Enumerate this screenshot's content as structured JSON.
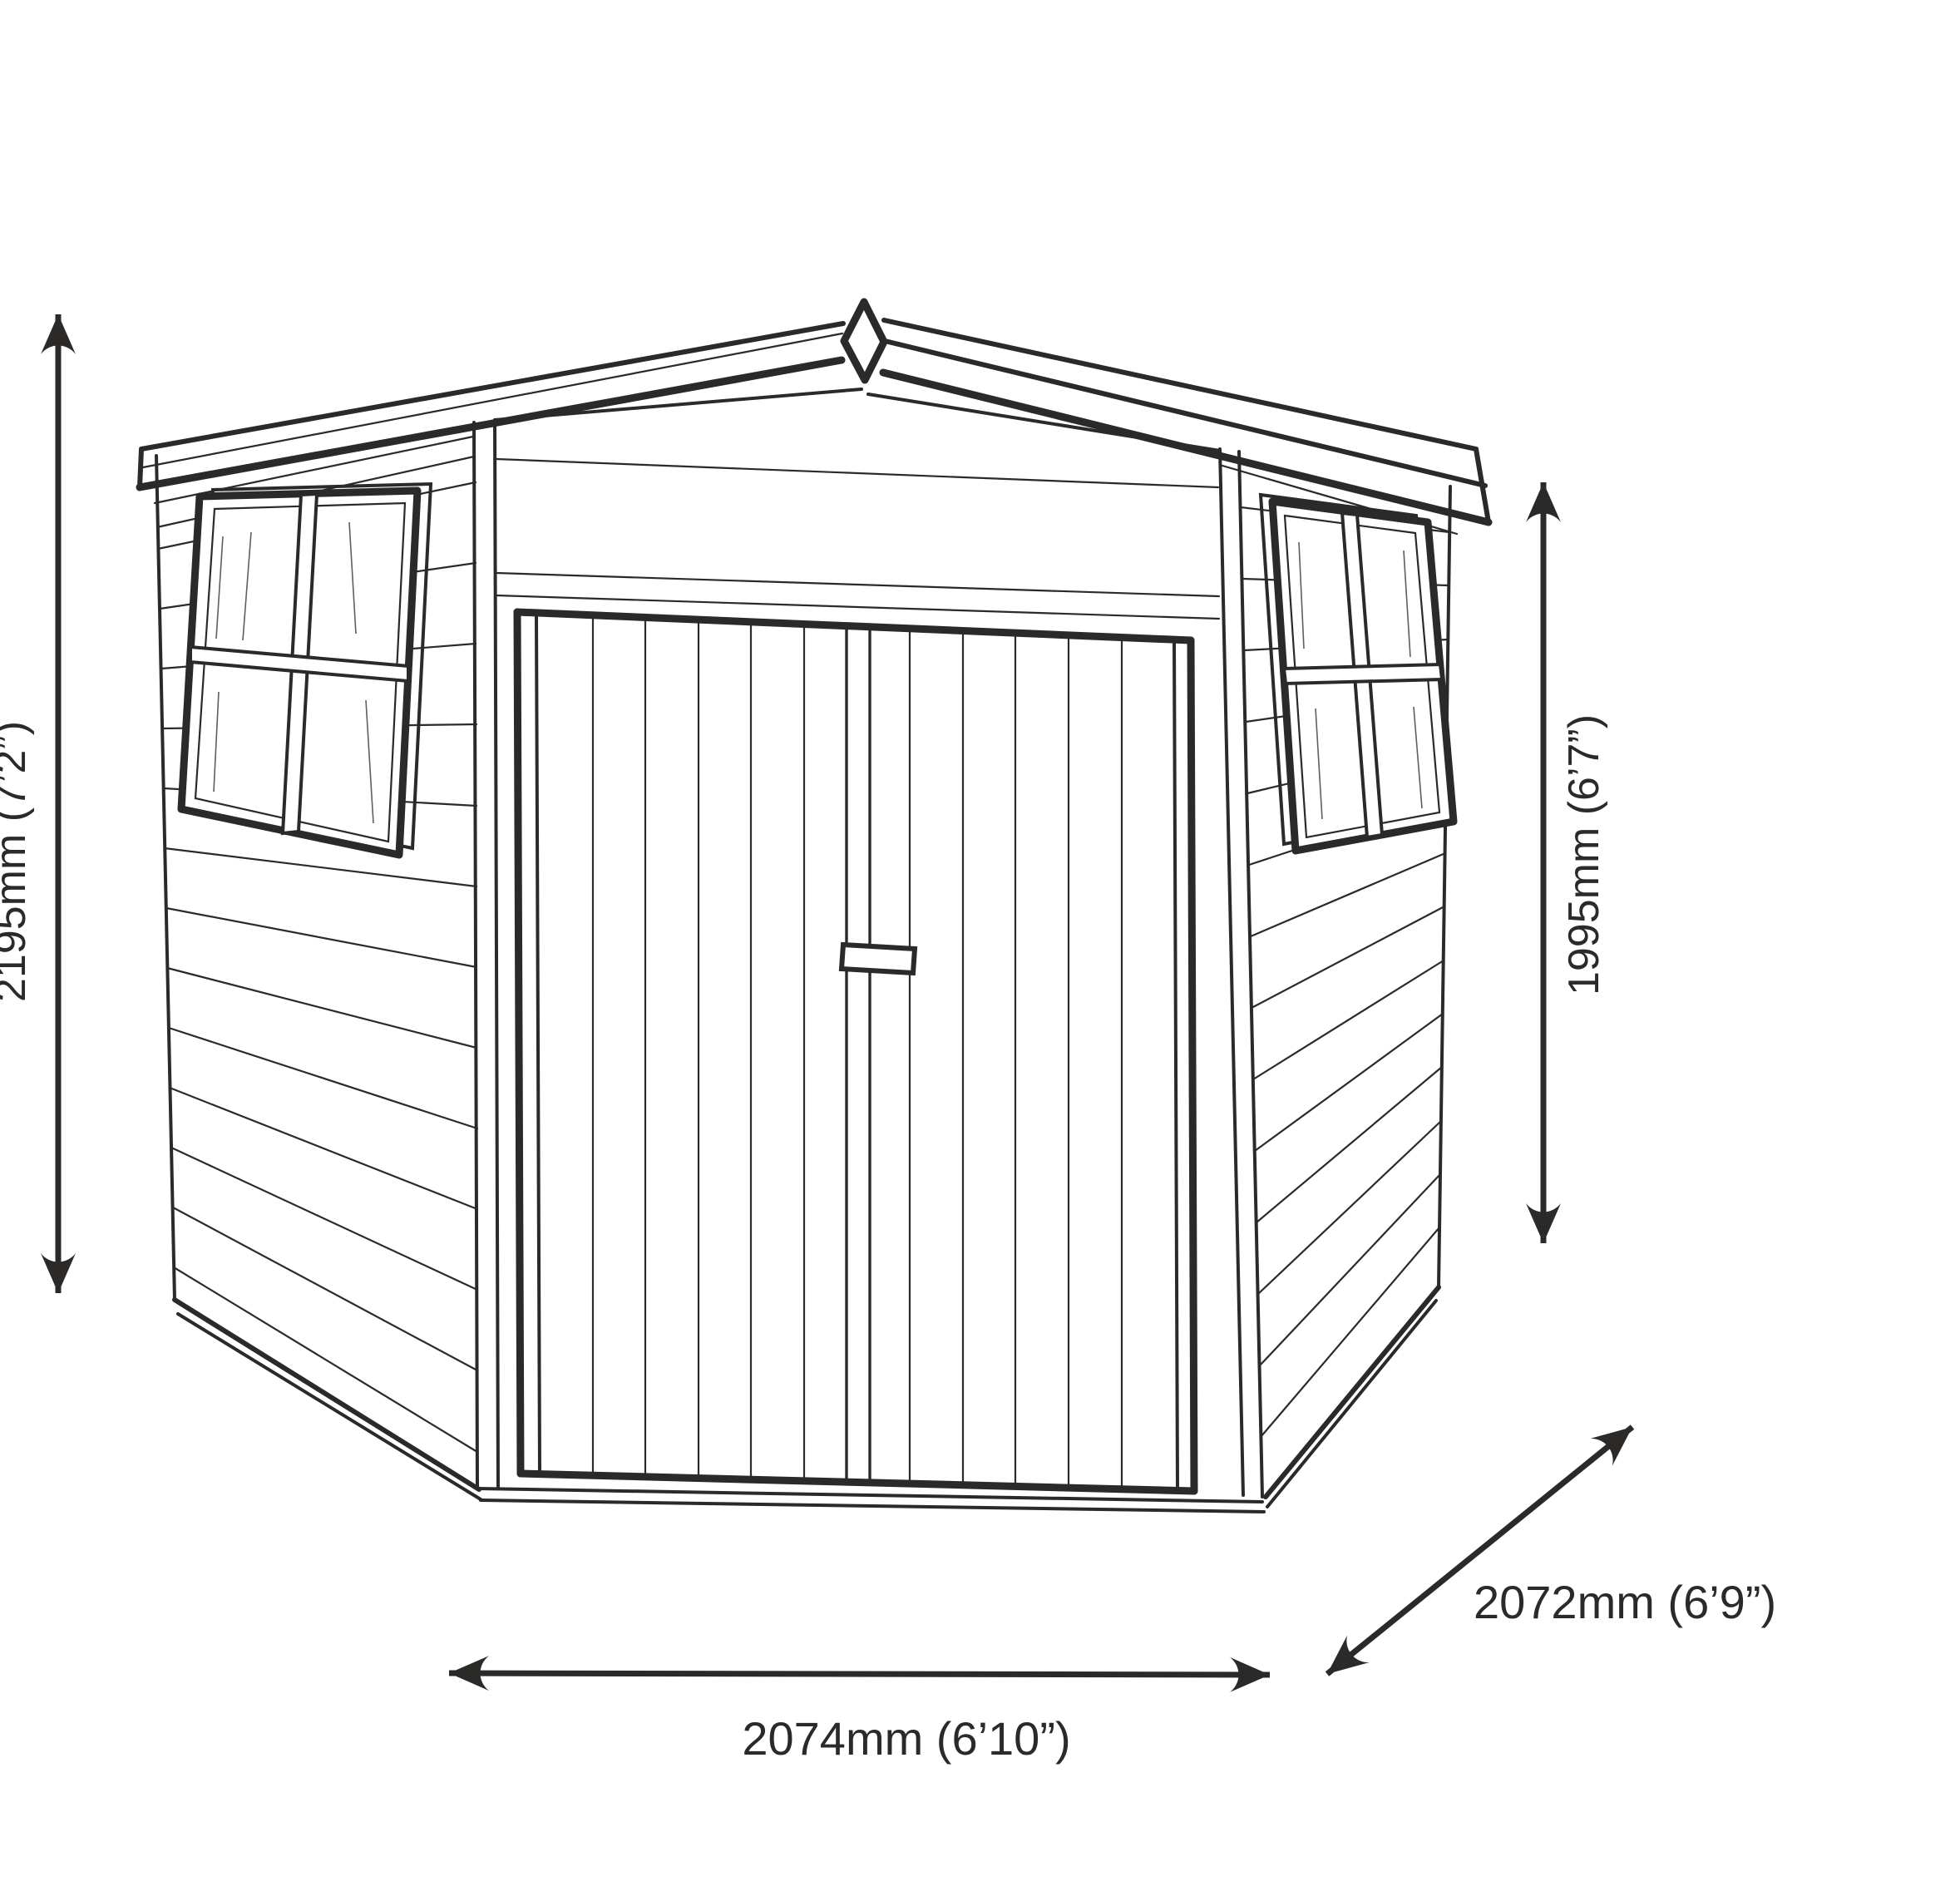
{
  "diagram": {
    "dimensions": {
      "height_left": {
        "label": "2195mm (7’2”)"
      },
      "height_right": {
        "label": "1995mm (6’7”)"
      },
      "width_front": {
        "label": "2074mm (6’10”)"
      },
      "depth_side": {
        "label": "2072mm (6’9”)"
      }
    },
    "colors": {
      "ink": "#2b2a29",
      "paper": "#ffffff"
    },
    "icons": {
      "dimension_arrows": "double-headed-arrow",
      "roof_finial": "diamond-finial"
    }
  }
}
